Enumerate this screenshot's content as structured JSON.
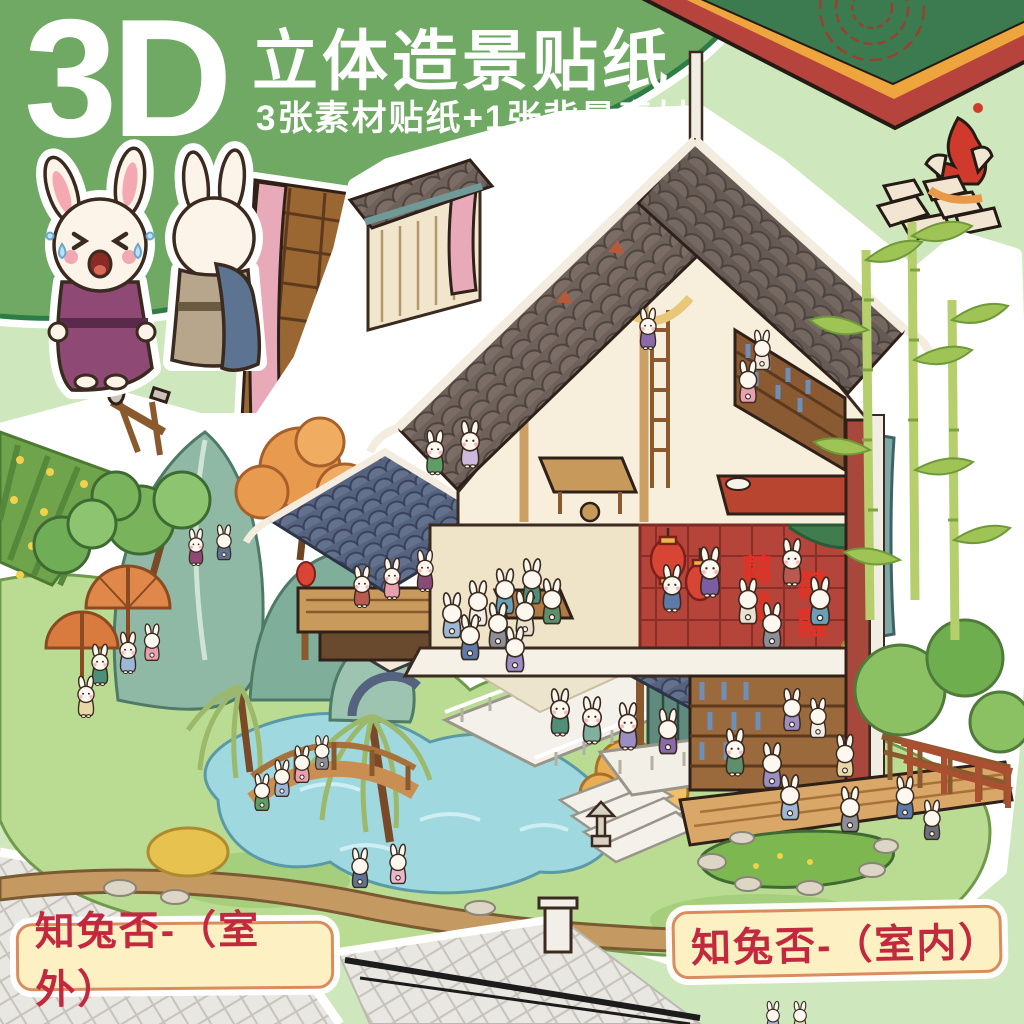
{
  "page": {
    "background": "#cfe7bd"
  },
  "header": {
    "badge": "3D",
    "title": "立体造景贴纸",
    "subtitle": "3张素材贴纸+1张背景素材",
    "band_color": "#6fa963",
    "band_edge": "#2e7d46",
    "text_color": "#ffffff"
  },
  "corner_mat": {
    "red": "#b6433c",
    "trim": "#efa53e",
    "green": "#3c7a50",
    "pattern": "#a8392c"
  },
  "scene": {
    "double_happiness": "囍",
    "palette": {
      "roof_gray": "#6e615a",
      "roof_blue": "#56637f",
      "wood": "#c89a5c",
      "red_wall": "#b5443a",
      "lantern_red": "#d84535",
      "mountain_teal": "#8fb9a4",
      "pond_blue": "#9fd8de",
      "grass": "#b9dc92",
      "path_tan": "#c49a62",
      "bamboo": "#9fc455"
    }
  },
  "labels": {
    "outdoor": "知兔否-（室外）",
    "indoor": "知兔否-（室内）",
    "background": "#fdf0c2",
    "border": "#d98d5e",
    "text_color": "#c2293f"
  }
}
